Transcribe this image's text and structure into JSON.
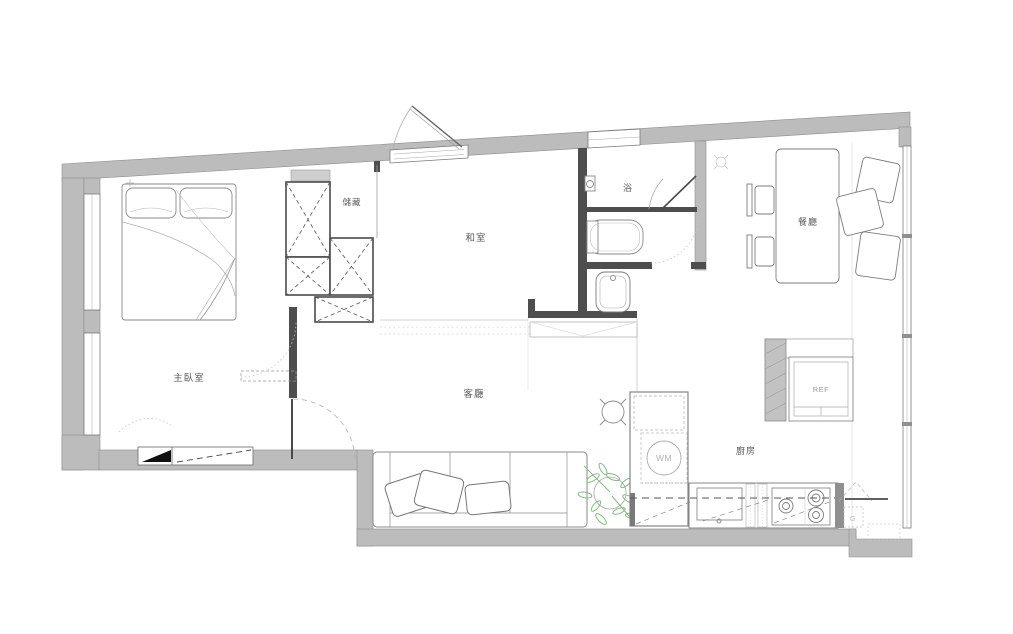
{
  "rooms": {
    "master_bedroom": "主臥室",
    "storage": "儲藏",
    "tatami": "和室",
    "bath": "浴",
    "dining": "餐廳",
    "living": "客廳",
    "kitchen": "廚房"
  },
  "appliances": {
    "refrigerator": "REF",
    "washing_machine": "WM",
    "gas": "G"
  },
  "colors": {
    "exterior_wall": "#bcbcbc",
    "interior_wall": "#4e4e4e",
    "window_frame": "#7a7a7a",
    "furniture_line": "#8a8a8a",
    "plant": "#85b885",
    "background": "#ffffff"
  }
}
